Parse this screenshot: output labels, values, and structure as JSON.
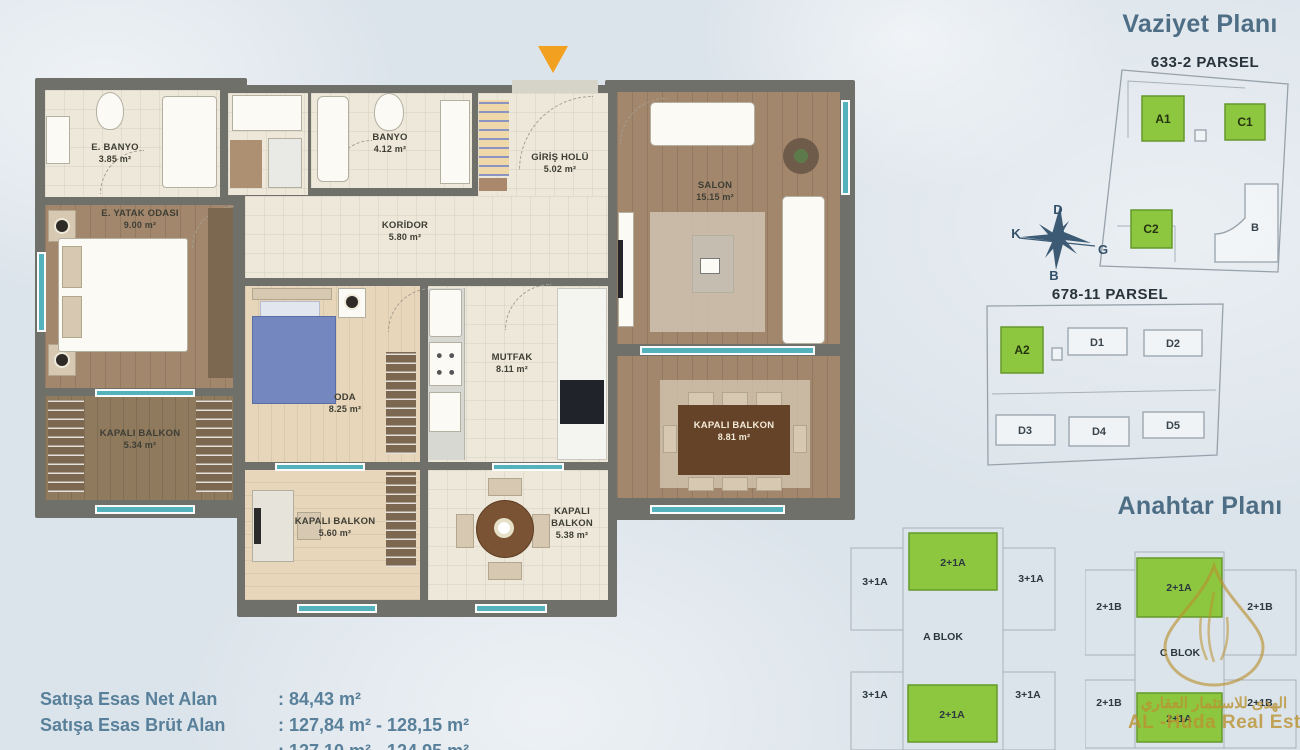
{
  "floor_plan": {
    "rooms": [
      {
        "name": "E. BANYO",
        "area": "3.85 m²"
      },
      {
        "name": "E. YATAK ODASI",
        "area": "9.00 m²"
      },
      {
        "name": "KAPALI BALKON",
        "area": "5.34 m²"
      },
      {
        "name": "BANYO",
        "area": "4.12 m²"
      },
      {
        "name": "GİRİŞ HOLÜ",
        "area": "5.02 m²"
      },
      {
        "name": "KORİDOR",
        "area": "5.80 m²"
      },
      {
        "name": "SALON",
        "area": "15.15 m²"
      },
      {
        "name": "ODA",
        "area": "8.25 m²"
      },
      {
        "name": "MUTFAK",
        "area": "8.11 m²"
      },
      {
        "name": "KAPALI BALKON",
        "area": "5.60 m²"
      },
      {
        "name": "KAPALI BALKON",
        "area": "5.38 m²"
      },
      {
        "name": "KAPALI BALKON",
        "area": "8.81 m²"
      }
    ]
  },
  "site_plan": {
    "title": "Vaziyet Planı",
    "parcel1": {
      "label": "633-2 PARSEL",
      "blocks": [
        {
          "id": "A1"
        },
        {
          "id": "C1"
        },
        {
          "id": "C2"
        },
        {
          "id": "B"
        }
      ]
    },
    "parcel2": {
      "label": "678-11 PARSEL",
      "blocks": [
        {
          "id": "A2"
        },
        {
          "id": "D1"
        },
        {
          "id": "D2"
        },
        {
          "id": "D3"
        },
        {
          "id": "D4"
        },
        {
          "id": "D5"
        }
      ]
    },
    "compass": {
      "n": "D",
      "w": "K",
      "e": "G",
      "s": "B"
    }
  },
  "key_plan": {
    "title": "Anahtar Planı",
    "a_blok": {
      "label": "A BLOK",
      "green_top": "2+1A",
      "green_bottom": "2+1A",
      "corners": [
        "3+1A",
        "3+1A",
        "3+1A",
        "3+1A"
      ]
    },
    "c_blok": {
      "label": "C BLOK",
      "green_top": "2+1A",
      "green_bottom": "2+1A",
      "corners": [
        "2+1B",
        "2+1B",
        "2+1B",
        "2+1B"
      ]
    }
  },
  "info": {
    "rows": [
      {
        "label": "Satışa Esas Net Alan",
        "value": ": 84,43 m²"
      },
      {
        "label": "Satışa Esas Brüt Alan",
        "value": ": 127,84 m² - 128,15 m²"
      },
      {
        "label": "",
        "value": ": 127,10 m² - 124,95 m²"
      }
    ]
  },
  "watermark": {
    "line1": "الهدى للاستثمار العقاري",
    "line2": "AL -Huda Real Estate"
  },
  "colors": {
    "green": "#8dc63f",
    "accent_blue": "#4e6e86",
    "wall": "#70706a",
    "gold": "#ba9232",
    "window": "#54b2bc",
    "entrance_arrow": "#f1a01f"
  }
}
